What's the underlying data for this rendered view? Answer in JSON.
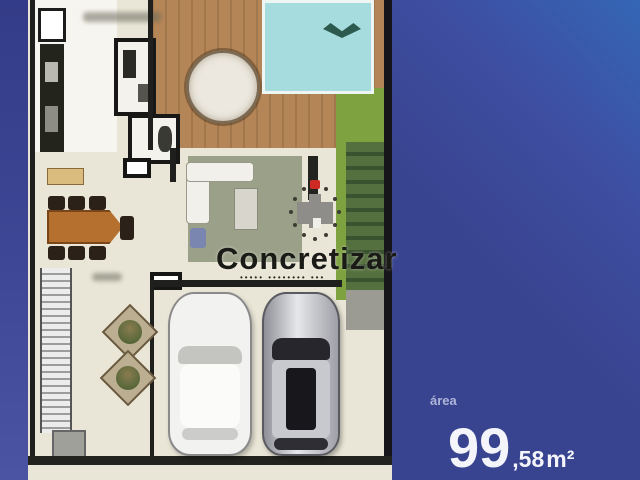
{
  "image_type": "real-estate floor plan photo",
  "watermark": {
    "brand": "Concretizar",
    "tagline": "••••• •••••••• •••",
    "logo_colors": {
      "body": "#8f8d8a",
      "accent_red": "#ce2b24",
      "dots": "#3c3c34"
    }
  },
  "right_panel": {
    "area_label": "área",
    "area_value_main": "99",
    "area_value_decimal": ",58",
    "area_unit": "m²",
    "background": "#394490",
    "background_light": "#3566b6",
    "text_color": "#f4f5fa"
  },
  "floor_plan": {
    "features": [
      "pool with hammock",
      "wood deck with round table",
      "kitchen with counter",
      "two bathrooms",
      "dining table with six chairs",
      "living rug with L-sofa",
      "staircase",
      "garage with white car and silver car",
      "two planters",
      "lawn and hedge strip"
    ],
    "colors": {
      "floor": "#eae6d7",
      "kitchen_floor": "#f7f5ef",
      "deck": "#b48557",
      "pool": "#a7dcde",
      "grass": "#7ea23f",
      "hedge": "#55703f",
      "wall": "#1f1f1d",
      "rug": "#9ba189",
      "dining_table": "#b5702f",
      "band_blue": "#3d4795"
    }
  }
}
